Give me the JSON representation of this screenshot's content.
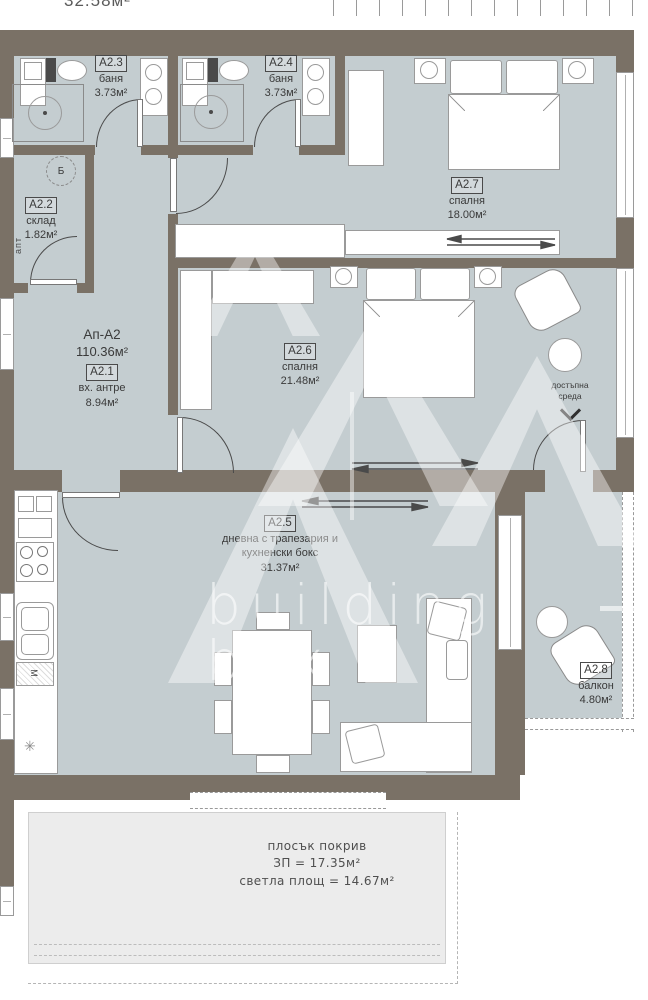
{
  "colors": {
    "floor_fill": "#c4cdd0",
    "wall_fill": "#7a7166",
    "roof_fill": "#ececec",
    "label_text": "#3a3a3a"
  },
  "watermark": {
    "line1": "building",
    "line2": "box"
  },
  "adjacent": {
    "top_area_text": "32.58м²"
  },
  "apartment": {
    "id_label": "Ап-А2",
    "total_area": "110.36м²"
  },
  "rooms": [
    {
      "id": "A2.1",
      "name": "вх. антре",
      "area": "8.94м²"
    },
    {
      "id": "A2.2",
      "name": "склад",
      "area": "1.82м²"
    },
    {
      "id": "A2.3",
      "name": "баня",
      "area": "3.73м²"
    },
    {
      "id": "A2.4",
      "name": "баня",
      "area": "3.73м²"
    },
    {
      "id": "A2.5",
      "name": "дневна с трапезария и кухненски бокс",
      "name_line1": "дневна с трапезария и",
      "name_line2": "кухненски бокс",
      "area": "31.37м²"
    },
    {
      "id": "A2.6",
      "name": "спалня",
      "area": "21.48м²"
    },
    {
      "id": "A2.7",
      "name": "спалня",
      "area": "18.00м²"
    },
    {
      "id": "A2.8",
      "name": "балкон",
      "area": "4.80м²"
    }
  ],
  "annotations": {
    "stair_core": "Б",
    "shaft_label": "апт",
    "accessible_line1": "достъпна",
    "accessible_line2": "среда",
    "appliance_m": "М",
    "star_symbol": "✳",
    "roof": {
      "title": "плосък покрив",
      "built_area": "ЗП = 17.35м²",
      "clear_area": "светла площ = 14.67м²"
    }
  }
}
